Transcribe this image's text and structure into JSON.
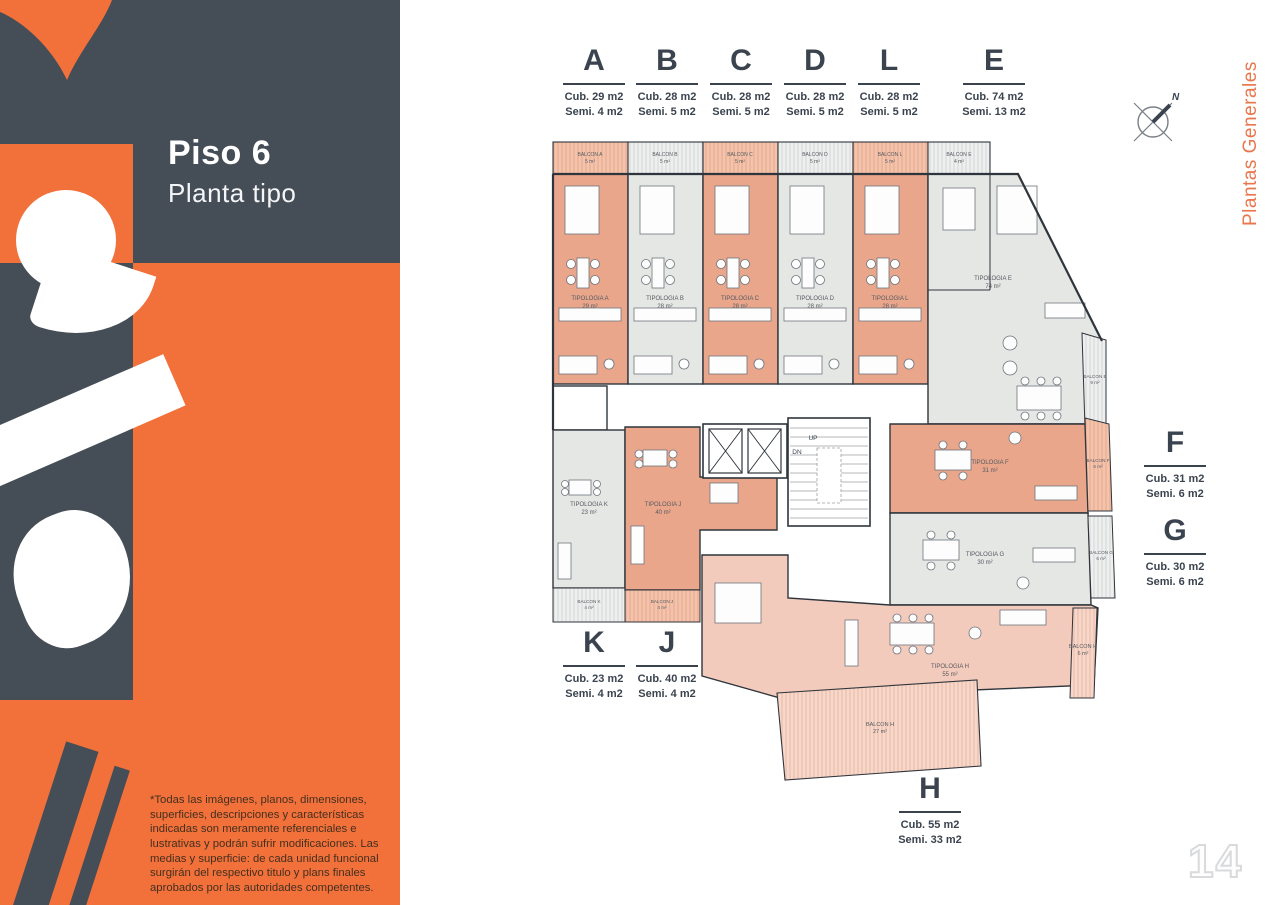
{
  "page": {
    "number": "14",
    "side_tab": "Plantas Generales"
  },
  "sidebar": {
    "title": "Piso 6",
    "subtitle": "Planta tipo",
    "disclaimer": "*Todas las imágenes, planos, dimensiones, superficies, descripciones y características indicadas son meramente referenciales e lustrativas y podrán sufrir modificaciones. Las medias y superficie: de cada unidad funcional surgirán del respectivo titulo y plans finales aprobados por las autoridades competentes."
  },
  "compass": {
    "label": "N"
  },
  "headers": {
    "top": [
      {
        "letter": "A",
        "cub": "Cub. 29 m2",
        "semi": "Semi. 4 m2"
      },
      {
        "letter": "B",
        "cub": "Cub. 28 m2",
        "semi": "Semi. 5 m2"
      },
      {
        "letter": "C",
        "cub": "Cub. 28 m2",
        "semi": "Semi. 5 m2"
      },
      {
        "letter": "D",
        "cub": "Cub. 28 m2",
        "semi": "Semi. 5 m2"
      },
      {
        "letter": "L",
        "cub": "Cub. 28 m2",
        "semi": "Semi. 5 m2"
      },
      {
        "letter": "E",
        "cub": "Cub. 74 m2",
        "semi": "Semi. 13 m2"
      }
    ],
    "right": [
      {
        "letter": "F",
        "cub": "Cub. 31 m2",
        "semi": "Semi. 6 m2"
      },
      {
        "letter": "G",
        "cub": "Cub. 30 m2",
        "semi": "Semi. 6 m2"
      }
    ],
    "bottom_left": [
      {
        "letter": "K",
        "cub": "Cub. 23 m2",
        "semi": "Semi. 4 m2"
      },
      {
        "letter": "J",
        "cub": "Cub. 40 m2",
        "semi": "Semi. 4 m2"
      }
    ],
    "bottom": [
      {
        "letter": "H",
        "cub": "Cub. 55 m2",
        "semi": "Semi. 33 m2"
      }
    ]
  },
  "plan": {
    "tipologias": [
      {
        "name": "TIPOLOGIA A",
        "area": "29 m²"
      },
      {
        "name": "TIPOLOGIA B",
        "area": "28 m²"
      },
      {
        "name": "TIPOLOGIA C",
        "area": "28 m²"
      },
      {
        "name": "TIPOLOGIA D",
        "area": "28 m²"
      },
      {
        "name": "TIPOLOGIA L",
        "area": "28 m²"
      },
      {
        "name": "TIPOLOGIA E",
        "area": "74 m²"
      },
      {
        "name": "TIPOLOGIA F",
        "area": "31 m²"
      },
      {
        "name": "TIPOLOGIA G",
        "area": "30 m²"
      },
      {
        "name": "TIPOLOGIA K",
        "area": "23 m²"
      },
      {
        "name": "TIPOLOGIA J",
        "area": "40 m²"
      },
      {
        "name": "TIPOLOGIA H",
        "area": "55 m²"
      }
    ],
    "balcones": [
      {
        "name": "BALCON A",
        "area": "5 m²"
      },
      {
        "name": "BALCON B",
        "area": "5 m²"
      },
      {
        "name": "BALCON C",
        "area": "5 m²"
      },
      {
        "name": "BALCON D",
        "area": "5 m²"
      },
      {
        "name": "BALCON L",
        "area": "5 m²"
      },
      {
        "name": "BALCON E",
        "area": "4 m²"
      },
      {
        "name": "BALCON E",
        "area": "9 m²"
      },
      {
        "name": "BALCON F",
        "area": "6 m²"
      },
      {
        "name": "BALCON G",
        "area": "6 m²"
      },
      {
        "name": "BALCON K",
        "area": "4 m²"
      },
      {
        "name": "BALCON J",
        "area": "4 m²"
      },
      {
        "name": "BALCON H",
        "area": "27 m²"
      },
      {
        "name": "BALCON H",
        "area": "6 m²"
      }
    ],
    "core": {
      "up": "UP",
      "dn": "DN"
    }
  },
  "colors": {
    "accent_orange": "#F2703A",
    "dark_slate": "#454D57",
    "ink": "#3A434E",
    "unit_salmon": "#E9A68B",
    "unit_gray": "#E5E7E5",
    "unit_pink": "#F3CBBC",
    "page_number_outline": "#D8DADC"
  }
}
